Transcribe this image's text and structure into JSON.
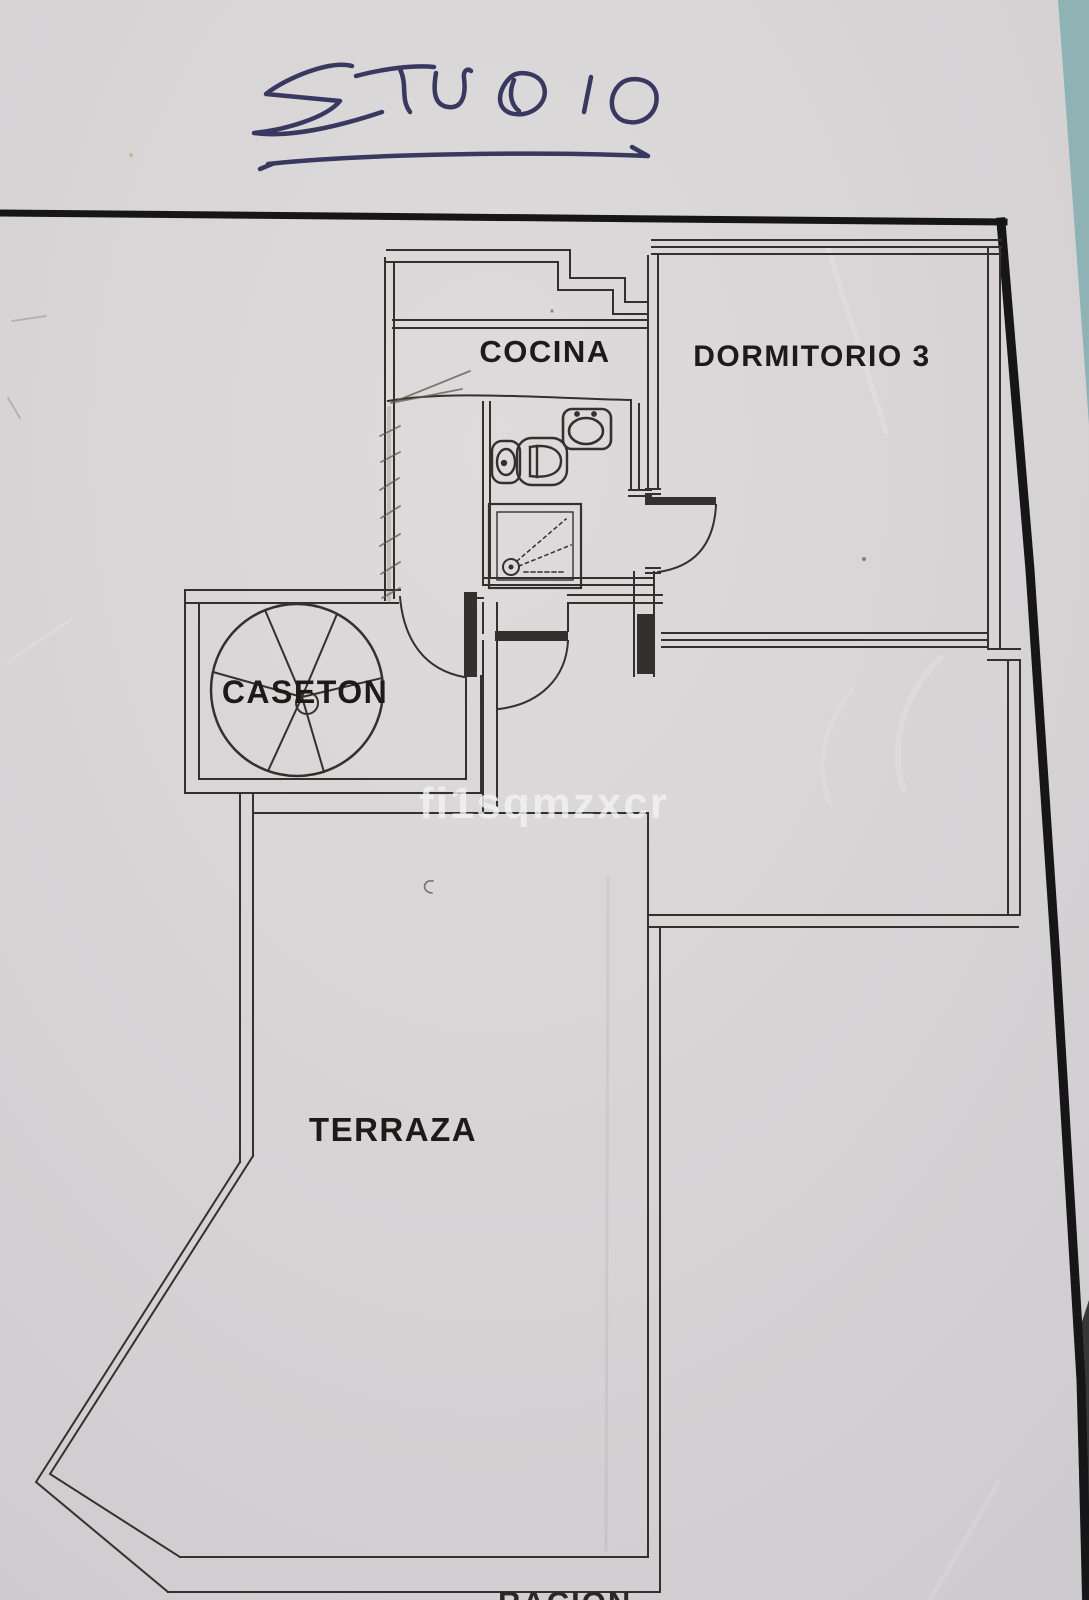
{
  "photo": {
    "background_color": "#8fb3b5",
    "paper_color": "#d6d3d5"
  },
  "handwriting": {
    "title": "STUDIO",
    "ink_color": "#2b2b56"
  },
  "watermark": {
    "text": "fi1sqmzxcr",
    "color": "#f2f2f4"
  },
  "floor_plan": {
    "line_color": "#34302d",
    "border_color": "#161616",
    "label_color": "#1d1b19",
    "rooms": [
      {
        "label": "COCINA"
      },
      {
        "label": "DORMITORIO 3"
      },
      {
        "label": "CASETON"
      },
      {
        "label": "TERRAZA"
      }
    ],
    "fixtures": [
      {
        "name": "spiral-staircase"
      },
      {
        "name": "toilet"
      },
      {
        "name": "bidet"
      },
      {
        "name": "washbasin"
      },
      {
        "name": "shower-tray"
      }
    ],
    "partial_bottom_text": "RACION"
  }
}
